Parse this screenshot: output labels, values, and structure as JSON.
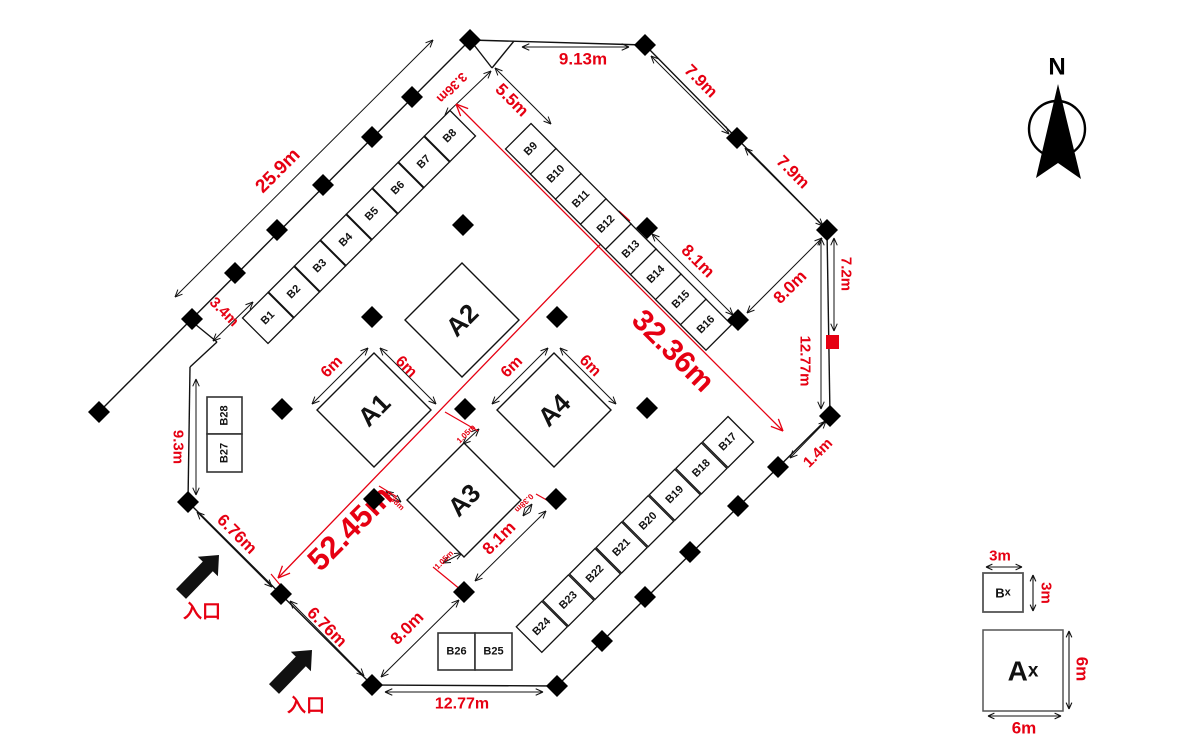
{
  "colors": {
    "red": "#e60012",
    "line": "#111111"
  },
  "plan": {
    "walls": [
      [
        470,
        40,
        645,
        45
      ],
      [
        645,
        45,
        827,
        230
      ],
      [
        827,
        230,
        830,
        416
      ],
      [
        830,
        416,
        557,
        686
      ],
      [
        557,
        686,
        372,
        685
      ],
      [
        372,
        685,
        188,
        502
      ],
      [
        188,
        502,
        190,
        367
      ],
      [
        190,
        367,
        217,
        342
      ],
      [
        217,
        342,
        190,
        320
      ],
      [
        470,
        40,
        99,
        412
      ],
      [
        471,
        41,
        492,
        68
      ],
      [
        492,
        68,
        514,
        41
      ]
    ],
    "posts": [
      [
        470,
        40
      ],
      [
        412,
        97
      ],
      [
        372,
        137
      ],
      [
        323,
        185
      ],
      [
        277,
        230
      ],
      [
        235,
        273
      ],
      [
        192,
        319
      ],
      [
        99,
        412
      ],
      [
        645,
        45
      ],
      [
        737,
        138
      ],
      [
        827,
        230
      ],
      [
        830,
        416
      ],
      [
        778,
        467
      ],
      [
        738,
        506
      ],
      [
        690,
        552
      ],
      [
        645,
        597
      ],
      [
        602,
        641
      ],
      [
        557,
        686
      ],
      [
        372,
        685
      ],
      [
        281,
        594
      ],
      [
        188,
        502
      ],
      [
        738,
        320
      ],
      [
        647,
        228
      ],
      [
        463,
        225
      ],
      [
        372,
        317
      ],
      [
        557,
        317
      ],
      [
        282,
        409
      ],
      [
        465,
        409
      ],
      [
        647,
        408
      ],
      [
        374,
        499
      ],
      [
        556,
        499
      ],
      [
        464,
        592
      ]
    ],
    "red_marker": {
      "x": 826,
      "y": 335,
      "w": 13,
      "h": 14
    },
    "booth_rows": [
      {
        "labels": [
          "B1",
          "B2",
          "B3",
          "B4",
          "B5",
          "B6",
          "B7",
          "B8"
        ],
        "start": [
          268,
          318
        ],
        "step": [
          26,
          -26
        ],
        "half": 25.5
      },
      {
        "labels": [
          "B9",
          "B10",
          "B11",
          "B12",
          "B13",
          "B14",
          "B15",
          "B16"
        ],
        "start": [
          531,
          149
        ],
        "step": [
          25,
          25.1
        ],
        "half": 25.5
      },
      {
        "labels": [
          "B17",
          "B18",
          "B19",
          "B20",
          "B21",
          "B22",
          "B23",
          "B24"
        ],
        "start": [
          728,
          442
        ],
        "step": [
          -26.6,
          26.4
        ],
        "half": 25.5
      }
    ],
    "booth_boxes": [
      {
        "label": "B28",
        "x": 207,
        "y": 397,
        "w": 35,
        "h": 37,
        "rot": -90
      },
      {
        "label": "B27",
        "x": 207,
        "y": 434,
        "w": 35,
        "h": 38,
        "rot": -90
      },
      {
        "label": "B26",
        "x": 438,
        "y": 633,
        "w": 37,
        "h": 37,
        "rot": 0
      },
      {
        "label": "B25",
        "x": 475,
        "y": 633,
        "w": 37,
        "h": 37,
        "rot": 0
      }
    ],
    "a_booths": [
      {
        "label": "A1",
        "cx": 374,
        "cy": 410,
        "half": 57
      },
      {
        "label": "A2",
        "cx": 462,
        "cy": 320,
        "half": 57
      },
      {
        "label": "A3",
        "cx": 464,
        "cy": 500,
        "half": 57
      },
      {
        "label": "A4",
        "cx": 554,
        "cy": 410,
        "half": 57
      }
    ],
    "dimensions": [
      {
        "v": "25.9m",
        "line": [
          175,
          297,
          433,
          40
        ],
        "label": [
          278,
          171
        ],
        "rot": -45,
        "size": 19
      },
      {
        "v": "3.4m",
        "line": [
          253,
          302,
          213,
          341
        ],
        "label": [
          224,
          312
        ],
        "rot": 45,
        "size": 15
      },
      {
        "v": "9.13m",
        "line": [
          522,
          47,
          629,
          47
        ],
        "label": [
          583,
          59
        ],
        "rot": 0,
        "size": 17
      },
      {
        "v": "3.36m",
        "line": [
          445,
          115,
          491,
          71
        ],
        "label": [
          452,
          88
        ],
        "rot": 135,
        "size": 13
      },
      {
        "v": "5.5m",
        "line": [
          495,
          68,
          551,
          124
        ],
        "label": [
          512,
          100
        ],
        "rot": 45,
        "size": 17
      },
      {
        "v": "7.9m",
        "line": [
          651,
          56,
          729,
          134
        ],
        "label": [
          701,
          81
        ],
        "rot": 45,
        "size": 17
      },
      {
        "v": "7.9m",
        "line": [
          745,
          148,
          823,
          226
        ],
        "label": [
          793,
          172
        ],
        "rot": 45,
        "size": 17
      },
      {
        "v": "8.1m",
        "line": [
          652,
          234,
          733,
          315
        ],
        "label": [
          698,
          261
        ],
        "rot": 45,
        "size": 17
      },
      {
        "v": "8.0m",
        "line": [
          747,
          313,
          822,
          238
        ],
        "label": [
          790,
          287
        ],
        "rot": -45,
        "size": 17
      },
      {
        "v": "7.2m",
        "line": [
          834,
          238,
          834,
          331
        ],
        "label": [
          846,
          274
        ],
        "rot": 90,
        "size": 15
      },
      {
        "v": "12.77m",
        "line": [
          821,
          238,
          821,
          409
        ],
        "label": [
          805,
          361
        ],
        "rot": 90,
        "size": 15
      },
      {
        "v": "1.4m",
        "line": [
          826,
          421,
          790,
          458
        ],
        "label": [
          818,
          453
        ],
        "rot": -45,
        "size": 15
      },
      {
        "v": "12.77m",
        "line": [
          385,
          692,
          543,
          692
        ],
        "label": [
          462,
          704
        ],
        "rot": 0,
        "size": 16
      },
      {
        "v": "8.0m",
        "line": [
          381,
          677,
          459,
          600
        ],
        "label": [
          407,
          628
        ],
        "rot": -45,
        "size": 17
      },
      {
        "v": "6.76m",
        "line": [
          290,
          601,
          364,
          676
        ],
        "label": [
          327,
          627
        ],
        "rot": 45,
        "size": 17
      },
      {
        "v": "6.76m",
        "line": [
          197,
          512,
          272,
          587
        ],
        "label": [
          237,
          534
        ],
        "rot": 45,
        "size": 17
      },
      {
        "v": "9.3m",
        "line": [
          196,
          379,
          196,
          495
        ],
        "label": [
          178,
          447
        ],
        "rot": 90,
        "size": 15
      },
      {
        "v": "8.1m",
        "line": [
          546,
          511,
          475,
          581
        ],
        "label": [
          499,
          538
        ],
        "rot": -45,
        "size": 17
      },
      {
        "v": "6m",
        "line": [
          312,
          404,
          368,
          348
        ],
        "label": [
          332,
          367
        ],
        "rot": -45,
        "size": 16
      },
      {
        "v": "6m",
        "line": [
          380,
          348,
          436,
          404
        ],
        "label": [
          406,
          367
        ],
        "rot": 45,
        "size": 16
      },
      {
        "v": "6m",
        "line": [
          492,
          404,
          548,
          348
        ],
        "label": [
          512,
          367
        ],
        "rot": -45,
        "size": 16
      },
      {
        "v": "6m",
        "line": [
          560,
          348,
          616,
          404
        ],
        "label": [
          590,
          366
        ],
        "rot": 45,
        "size": 16
      },
      {
        "v": "1.05m",
        "line": [
          463,
          444,
          479,
          429
        ],
        "label": [
          466,
          434
        ],
        "rot": -45,
        "size": 8
      },
      {
        "v": "0.38m",
        "line": [
          386,
          491,
          401,
          502
        ],
        "label": [
          395,
          501
        ],
        "rot": 45,
        "size": 8
      },
      {
        "v": "0.38m",
        "line": [
          523,
          516,
          532,
          504
        ],
        "label": [
          524,
          503
        ],
        "rot": 135,
        "size": 8
      },
      {
        "v": "1.05m",
        "line": [
          443,
          563,
          462,
          553
        ],
        "label": [
          444,
          560
        ],
        "rot": -45,
        "size": 8
      }
    ],
    "red_dimensions": [
      {
        "v": "32.36m",
        "line": [
          456,
          104,
          783,
          431
        ],
        "label": [
          673,
          351
        ],
        "rot": 45,
        "size": 30
      },
      {
        "v": "52.45m",
        "line": [
          620,
          224,
          278,
          578
        ],
        "label": [
          350,
          528
        ],
        "rot": -45,
        "size": 31
      }
    ],
    "ticks": [
      [
        445,
        412,
        478,
        431
      ],
      [
        379,
        486,
        397,
        497
      ],
      [
        433,
        567,
        461,
        590
      ],
      [
        536,
        494,
        552,
        503
      ],
      [
        271,
        574,
        281,
        586
      ],
      [
        619,
        211,
        630,
        221
      ]
    ]
  },
  "entrances": [
    {
      "label": "入口",
      "tail": [
        181,
        594
      ],
      "tip": [
        219,
        555
      ],
      "label_pos": [
        202,
        612
      ]
    },
    {
      "label": "入口",
      "tail": [
        274,
        689
      ],
      "tip": [
        312,
        650
      ],
      "label_pos": [
        306,
        706
      ]
    }
  ],
  "north": {
    "label": "N",
    "label_pos": [
      1057,
      67
    ],
    "circle": [
      1057,
      129,
      28
    ],
    "dart": [
      [
        1058,
        84
      ],
      [
        1081,
        179
      ],
      [
        1058,
        163
      ],
      [
        1036,
        178
      ]
    ]
  },
  "legend": {
    "items": [
      {
        "label_main": "B",
        "label_sub": "x",
        "box": [
          983,
          573,
          40,
          39
        ],
        "dims": [
          {
            "v": "3m",
            "line": [
              986,
              567,
              1022,
              567
            ],
            "label": [
              1000,
              556
            ],
            "rot": 0,
            "size": 15
          },
          {
            "v": "3m",
            "line": [
              1033,
              575,
              1033,
              611
            ],
            "label": [
              1046,
              593
            ],
            "rot": 90,
            "size": 15
          }
        ]
      },
      {
        "label_main": "A",
        "label_sub": "x",
        "box": [
          983,
          630,
          80,
          81
        ],
        "dims": [
          {
            "v": "6m",
            "line": [
              1069,
              631,
              1069,
              709
            ],
            "label": [
              1082,
              669
            ],
            "rot": 90,
            "size": 17
          },
          {
            "v": "6m",
            "line": [
              988,
              716,
              1061,
              716
            ],
            "label": [
              1024,
              728
            ],
            "rot": 0,
            "size": 17
          }
        ]
      }
    ]
  }
}
